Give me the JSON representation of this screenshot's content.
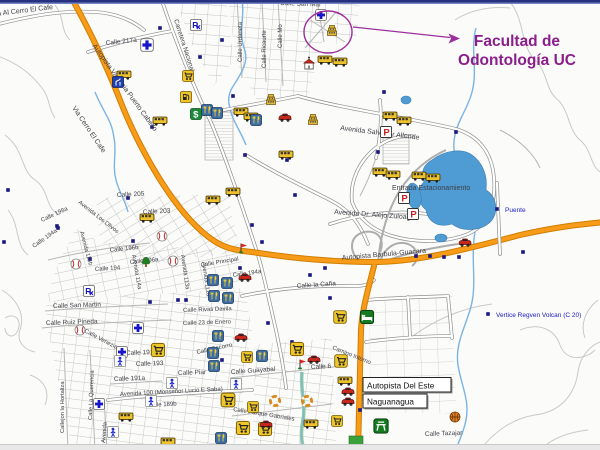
{
  "annotation": {
    "line1": "Facultad de",
    "line2": "Odontología UC",
    "color": "#8c1d8c",
    "shape_color": "#9c2f9c"
  },
  "map": {
    "callouts": {
      "autopista_del_este": "Autopista Del Este",
      "naguanagua": "Naguanagua"
    },
    "street_labels": [
      {
        "t": "ia Al Cerro El Cafe",
        "x": -4,
        "y": 16,
        "r": -7,
        "s": 7
      },
      {
        "t": "Calle 217a",
        "x": 106,
        "y": 45,
        "r": -6,
        "s": 6.5
      },
      {
        "t": "Calle San Mar",
        "x": 280,
        "y": 5,
        "r": 2,
        "s": 6.5
      },
      {
        "t": "Calle Urdaneta",
        "x": 242,
        "y": 62,
        "r": -90,
        "s": 6
      },
      {
        "t": "Calle Ricaurte",
        "x": 266,
        "y": 68,
        "r": -90,
        "s": 6
      },
      {
        "t": "Calle Mo",
        "x": 282,
        "y": 48,
        "r": -90,
        "s": 6
      },
      {
        "t": "Carretera Nacional",
        "x": 174,
        "y": 20,
        "r": 72,
        "s": 6.5
      },
      {
        "t": "Autopista Valencia Puerto Cabello",
        "x": 92,
        "y": 46,
        "r": 54,
        "s": 7
      },
      {
        "t": "Via Cerro El Cafe",
        "x": 72,
        "y": 108,
        "r": 56,
        "s": 7
      },
      {
        "t": "Calle 205",
        "x": 117,
        "y": 197,
        "r": -3,
        "s": 6.5
      },
      {
        "t": "Calle 203",
        "x": 143,
        "y": 214,
        "r": -3,
        "s": 6.5
      },
      {
        "t": "Calle 198a",
        "x": 42,
        "y": 222,
        "r": -25,
        "s": 6
      },
      {
        "t": "Calle 194a",
        "x": 34,
        "y": 248,
        "r": -35,
        "s": 6
      },
      {
        "t": "Avenida Los Olivos",
        "x": 78,
        "y": 203,
        "r": 38,
        "s": 5.8
      },
      {
        "t": "Avenida 115b",
        "x": 80,
        "y": 232,
        "r": 75,
        "s": 5.8
      },
      {
        "t": "Calle 196b",
        "x": 110,
        "y": 252,
        "r": -6,
        "s": 6
      },
      {
        "t": "Calle 196a",
        "x": 130,
        "y": 264,
        "r": -6,
        "s": 6
      },
      {
        "t": "Calle 194",
        "x": 95,
        "y": 271,
        "r": -4,
        "s": 6
      },
      {
        "t": "Avenida 114a",
        "x": 132,
        "y": 255,
        "r": 80,
        "s": 5.8
      },
      {
        "t": "Avenida 113a",
        "x": 181,
        "y": 255,
        "r": 82,
        "s": 5.8
      },
      {
        "t": "Avenida 112a",
        "x": 202,
        "y": 262,
        "r": 82,
        "s": 5.8
      },
      {
        "t": "Calle San Martin",
        "x": 53,
        "y": 308,
        "r": -2,
        "s": 6.5
      },
      {
        "t": "Calle Ruiz Pineda",
        "x": 46,
        "y": 325,
        "r": -2,
        "s": 6.5
      },
      {
        "t": "Calle Venezia",
        "x": 84,
        "y": 332,
        "r": 28,
        "s": 6
      },
      {
        "t": "Calle 191b",
        "x": 126,
        "y": 355,
        "r": -2,
        "s": 6.5
      },
      {
        "t": "Calle 193",
        "x": 136,
        "y": 366,
        "r": -2,
        "s": 6.5
      },
      {
        "t": "Calle 191a",
        "x": 114,
        "y": 381,
        "r": -2,
        "s": 6.5
      },
      {
        "t": "Callejon la Hortaliza",
        "x": 64,
        "y": 433,
        "r": -90,
        "s": 5.8
      },
      {
        "t": "Calle La Querencia",
        "x": 92,
        "y": 420,
        "r": -88,
        "s": 5.8
      },
      {
        "t": "Avenida",
        "x": 105,
        "y": 443,
        "r": -85,
        "s": 5.8
      },
      {
        "t": "Avenida 100 (Monseñor Lucio E Saba)",
        "x": 120,
        "y": 396,
        "r": -3,
        "s": 6
      },
      {
        "t": "Calle 189b",
        "x": 148,
        "y": 407,
        "r": -3,
        "s": 6
      },
      {
        "t": "Calle Piar",
        "x": 178,
        "y": 375,
        "r": -2,
        "s": 6.5
      },
      {
        "t": "Calle Socorro",
        "x": 197,
        "y": 354,
        "r": -12,
        "s": 6
      },
      {
        "t": "Calle Guayabal",
        "x": 231,
        "y": 374,
        "r": -4,
        "s": 6.5
      },
      {
        "t": "Calle 6",
        "x": 311,
        "y": 369,
        "r": -3,
        "s": 6.5
      },
      {
        "t": "Calle Parque Gabriales",
        "x": 233,
        "y": 411,
        "r": 9,
        "s": 6
      },
      {
        "t": "Camino Interno",
        "x": 332,
        "y": 349,
        "r": 22,
        "s": 6
      },
      {
        "t": "Calle la Caña",
        "x": 297,
        "y": 288,
        "r": -4,
        "s": 6.5
      },
      {
        "t": "Calle Rivas Davila",
        "x": 183,
        "y": 312,
        "r": -2,
        "s": 6
      },
      {
        "t": "Calle 23 de Enero",
        "x": 183,
        "y": 325,
        "r": -2,
        "s": 6
      },
      {
        "t": "Calle Principal",
        "x": 201,
        "y": 267,
        "r": -10,
        "s": 6
      },
      {
        "t": "Calle 194a",
        "x": 233,
        "y": 277,
        "r": -8,
        "s": 6
      },
      {
        "t": "Avenida Salvador Allende",
        "x": 340,
        "y": 130,
        "r": 7,
        "s": 7
      },
      {
        "t": "Entrada Estacionamiento",
        "x": 392,
        "y": 190,
        "r": 0,
        "s": 7
      },
      {
        "t": "Avenida Dr. Alejo Zuloaga",
        "x": 334,
        "y": 214,
        "r": 4,
        "s": 7
      },
      {
        "t": "Autopista Barbula-Guacara",
        "x": 342,
        "y": 260,
        "r": -5,
        "s": 7
      },
      {
        "t": "Calle Tazajar",
        "x": 425,
        "y": 436,
        "r": -2,
        "s": 6.5
      },
      {
        "t": "Puente",
        "x": 505,
        "y": 212,
        "r": 0,
        "s": 6.5,
        "c": "blue"
      },
      {
        "t": "Vertice Regven Volcan (C 20)",
        "x": 496,
        "y": 317,
        "r": 0,
        "s": 6.5,
        "c": "blue"
      }
    ],
    "poi_legend": {
      "hospital": "hospital-cross-icon",
      "pharmacy": "pharmacy-rx-icon",
      "bus": "bus-icon",
      "restaurant": "restaurant-icon",
      "shopping": "shopping-cart-icon",
      "bank": "bank-dollar-icon",
      "fuel": "fuel-pump-icon",
      "parking": "parking-icon",
      "car": "car-icon",
      "flag": "flag-icon",
      "tree": "park-tree-icon",
      "baseball": "baseball-icon",
      "basketball": "basketball-icon",
      "lifesaver": "lifesaver-icon",
      "lodging": "lodging-icon",
      "restarea": "rest-area-icon",
      "church": "church-icon",
      "building": "building-icon",
      "person": "pedestrian-icon",
      "sign": "highway-sign-icon"
    },
    "pois": [
      {
        "type": "hospital",
        "x": 321,
        "y": 15
      },
      {
        "type": "hospital",
        "x": 147,
        "y": 45,
        "sc": 1.15
      },
      {
        "type": "hospital",
        "x": 138,
        "y": 328
      },
      {
        "type": "hospital",
        "x": 122,
        "y": 352
      },
      {
        "type": "hospital",
        "x": 99,
        "y": 404
      },
      {
        "type": "pharmacy",
        "x": 196,
        "y": 25
      },
      {
        "type": "pharmacy",
        "x": 89,
        "y": 291
      },
      {
        "type": "bus",
        "x": 124,
        "y": 75
      },
      {
        "type": "bus",
        "x": 160,
        "y": 121
      },
      {
        "type": "bus",
        "x": 213,
        "y": 200
      },
      {
        "type": "bus",
        "x": 325,
        "y": 60
      },
      {
        "type": "bus",
        "x": 340,
        "y": 62
      },
      {
        "type": "bus",
        "x": 390,
        "y": 116
      },
      {
        "type": "bus",
        "x": 404,
        "y": 121
      },
      {
        "type": "bus",
        "x": 380,
        "y": 172
      },
      {
        "type": "bus",
        "x": 393,
        "y": 175
      },
      {
        "type": "bus",
        "x": 419,
        "y": 176
      },
      {
        "type": "bus",
        "x": 433,
        "y": 178
      },
      {
        "type": "bus",
        "x": 241,
        "y": 112
      },
      {
        "type": "bus",
        "x": 251,
        "y": 117
      },
      {
        "type": "bus",
        "x": 286,
        "y": 155
      },
      {
        "type": "bus",
        "x": 233,
        "y": 192
      },
      {
        "type": "bus",
        "x": 345,
        "y": 381
      },
      {
        "type": "bus",
        "x": 126,
        "y": 417
      },
      {
        "type": "bus",
        "x": 168,
        "y": 442
      },
      {
        "type": "bus",
        "x": 311,
        "y": 424
      },
      {
        "type": "bus",
        "x": 147,
        "y": 218
      },
      {
        "type": "shopping",
        "x": 158,
        "y": 350,
        "sc": 1.2
      },
      {
        "type": "shopping",
        "x": 297,
        "y": 349,
        "sc": 1.2
      },
      {
        "type": "shopping",
        "x": 340,
        "y": 317,
        "sc": 1.15
      },
      {
        "type": "shopping",
        "x": 341,
        "y": 361,
        "sc": 1.15
      },
      {
        "type": "shopping",
        "x": 228,
        "y": 400,
        "sc": 1.25
      },
      {
        "type": "shopping",
        "x": 253,
        "y": 407
      },
      {
        "type": "shopping",
        "x": 243,
        "y": 428,
        "sc": 1.2
      },
      {
        "type": "shopping",
        "x": 265,
        "y": 429,
        "sc": 1.2
      },
      {
        "type": "shopping",
        "x": 337,
        "y": 421
      },
      {
        "type": "shopping",
        "x": 247,
        "y": 357
      },
      {
        "type": "shopping",
        "x": 188,
        "y": 76
      },
      {
        "type": "restaurant",
        "x": 207,
        "y": 110
      },
      {
        "type": "restaurant",
        "x": 217,
        "y": 113
      },
      {
        "type": "restaurant",
        "x": 256,
        "y": 120
      },
      {
        "type": "restaurant",
        "x": 213,
        "y": 280
      },
      {
        "type": "restaurant",
        "x": 227,
        "y": 283
      },
      {
        "type": "restaurant",
        "x": 214,
        "y": 296
      },
      {
        "type": "restaurant",
        "x": 228,
        "y": 298
      },
      {
        "type": "restaurant",
        "x": 213,
        "y": 353
      },
      {
        "type": "restaurant",
        "x": 214,
        "y": 366
      },
      {
        "type": "restaurant",
        "x": 218,
        "y": 336
      },
      {
        "type": "restaurant",
        "x": 221,
        "y": 438
      },
      {
        "type": "restaurant",
        "x": 262,
        "y": 356
      },
      {
        "type": "bank",
        "x": 196,
        "y": 114
      },
      {
        "type": "fuel",
        "x": 186,
        "y": 97
      },
      {
        "type": "parking",
        "x": 386,
        "y": 132
      },
      {
        "type": "parking",
        "x": 404,
        "y": 198
      },
      {
        "type": "parking",
        "x": 413,
        "y": 214
      },
      {
        "type": "car",
        "x": 465,
        "y": 242
      },
      {
        "type": "car",
        "x": 245,
        "y": 277
      },
      {
        "type": "car",
        "x": 348,
        "y": 391
      },
      {
        "type": "car",
        "x": 348,
        "y": 401
      },
      {
        "type": "car",
        "x": 266,
        "y": 424
      },
      {
        "type": "car",
        "x": 314,
        "y": 359
      },
      {
        "type": "car",
        "x": 241,
        "y": 337
      },
      {
        "type": "car",
        "x": 285,
        "y": 117
      },
      {
        "type": "flag",
        "x": 243,
        "y": 248
      },
      {
        "type": "flag",
        "x": 302,
        "y": 364
      },
      {
        "type": "tree",
        "x": 146,
        "y": 262
      },
      {
        "type": "baseball",
        "x": 162,
        "y": 236
      },
      {
        "type": "baseball",
        "x": 173,
        "y": 261
      },
      {
        "type": "baseball",
        "x": 80,
        "y": 330
      },
      {
        "type": "baseball",
        "x": 76,
        "y": 264
      },
      {
        "type": "basketball",
        "x": 455,
        "y": 417
      },
      {
        "type": "lifesaver",
        "x": 275,
        "y": 401
      },
      {
        "type": "lifesaver",
        "x": 307,
        "y": 401
      },
      {
        "type": "lodging",
        "x": 367,
        "y": 317,
        "sc": 1.2
      },
      {
        "type": "restarea",
        "x": 381,
        "y": 426,
        "sc": 1.3
      },
      {
        "type": "church",
        "x": 309,
        "y": 63,
        "sc": 1.2
      },
      {
        "type": "building",
        "x": 332,
        "y": 30
      },
      {
        "type": "building",
        "x": 313,
        "y": 119
      },
      {
        "type": "building",
        "x": 271,
        "y": 99
      },
      {
        "type": "person",
        "x": 120,
        "y": 361
      },
      {
        "type": "person",
        "x": 113,
        "y": 432
      },
      {
        "type": "person",
        "x": 151,
        "y": 401
      },
      {
        "type": "person",
        "x": 172,
        "y": 383
      },
      {
        "type": "person",
        "x": 236,
        "y": 384
      },
      {
        "type": "sign",
        "x": 118,
        "y": 82
      }
    ],
    "road_nodes": [
      [
        160,
        28
      ],
      [
        200,
        57
      ],
      [
        222,
        40
      ],
      [
        233,
        96
      ],
      [
        245,
        155
      ],
      [
        262,
        242
      ],
      [
        240,
        268
      ],
      [
        287,
        160
      ],
      [
        325,
        268
      ],
      [
        268,
        323
      ],
      [
        330,
        298
      ],
      [
        378,
        152
      ],
      [
        416,
        256
      ],
      [
        430,
        256
      ],
      [
        444,
        257
      ],
      [
        459,
        257
      ],
      [
        497,
        209
      ],
      [
        488,
        314
      ],
      [
        523,
        252
      ],
      [
        133,
        241
      ],
      [
        90,
        259
      ],
      [
        57,
        226
      ],
      [
        178,
        300
      ],
      [
        150,
        302
      ],
      [
        360,
        410
      ],
      [
        310,
        275
      ],
      [
        252,
        225
      ],
      [
        295,
        195
      ],
      [
        152,
        127
      ],
      [
        8,
        190
      ],
      [
        4,
        242
      ],
      [
        58,
        228
      ],
      [
        128,
        198
      ],
      [
        456,
        132
      ],
      [
        384,
        92
      ],
      [
        292,
        342
      ],
      [
        186,
        300
      ],
      [
        222,
        360
      ]
    ],
    "colors": {
      "highway_fill": "#f79b18",
      "highway_casing": "#d07e00",
      "water": "#4f9cd4",
      "street_label": "#3e3e46",
      "blue_label": "#1818cc",
      "top_strip": "#25307e",
      "bottom_strip": "#e8e8e8"
    }
  }
}
